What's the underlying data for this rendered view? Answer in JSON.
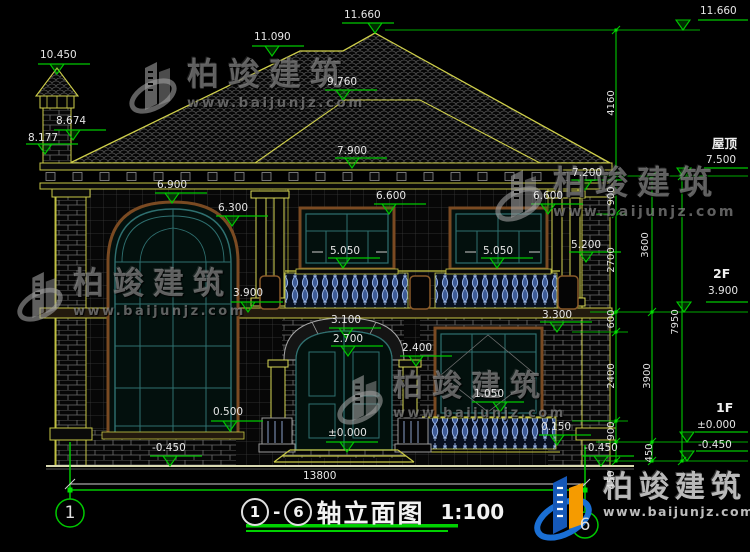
{
  "brand": {
    "name": "柏竣建筑",
    "url": "www.baijunjz.com"
  },
  "title_block": {
    "axis_start": "1",
    "separator": "-",
    "axis_end": "6",
    "name": "轴立面图",
    "scale": "1:100"
  },
  "axis_bubbles": {
    "left": "1",
    "right": "6"
  },
  "floor_labels": {
    "roof": "屋顶",
    "f2": "2F",
    "f1": "1F"
  },
  "overall_dim": {
    "v": "13800",
    "x": 303,
    "y": 471
  },
  "colors": {
    "dim_green": "#00c800",
    "line_yellow": "#c8c846",
    "text": "#e6e6e6",
    "logo_blue": "#1a6fd4",
    "logo_orange": "#f59b00"
  },
  "level_markers": [
    {
      "v": "10.450",
      "ax": 57,
      "ay": 74,
      "tx": 40,
      "ty": 50
    },
    {
      "v": "8.674",
      "ax": 73,
      "ay": 140,
      "tx": 56,
      "ty": 116
    },
    {
      "v": "8.177",
      "ax": 45,
      "ay": 154,
      "tx": 28,
      "ty": 133
    },
    {
      "v": "11.090",
      "ax": 272,
      "ay": 56,
      "tx": 254,
      "ty": 32
    },
    {
      "v": "11.660",
      "ax": 375,
      "ay": 33,
      "tx": 344,
      "ty": 10
    },
    {
      "v": "9.760",
      "ax": 343,
      "ay": 100,
      "tx": 327,
      "ty": 77
    },
    {
      "v": "7.900",
      "ax": 352,
      "ay": 168,
      "tx": 337,
      "ty": 146
    },
    {
      "v": "6.900",
      "ax": 172,
      "ay": 203,
      "tx": 157,
      "ty": 180
    },
    {
      "v": "6.300",
      "ax": 232,
      "ay": 226,
      "tx": 218,
      "ty": 203
    },
    {
      "v": "7.200",
      "ax": 585,
      "ay": 190,
      "tx": 572,
      "ty": 168
    },
    {
      "v": "6.600",
      "ax": 389,
      "ay": 214,
      "tx": 376,
      "ty": 191
    },
    {
      "v": "6.600",
      "ax": 548,
      "ay": 214,
      "tx": 533,
      "ty": 191
    },
    {
      "v": "5.050",
      "ax": 343,
      "ay": 268,
      "tx": 330,
      "ty": 246,
      "arrows": true
    },
    {
      "v": "5.050",
      "ax": 497,
      "ay": 268,
      "tx": 483,
      "ty": 246,
      "arrows": true
    },
    {
      "v": "5.200",
      "ax": 586,
      "ay": 262,
      "tx": 571,
      "ty": 240
    },
    {
      "v": "3.900",
      "ax": 248,
      "ay": 312,
      "tx": 233,
      "ty": 288
    },
    {
      "v": "3.300",
      "ax": 557,
      "ay": 332,
      "tx": 542,
      "ty": 310
    },
    {
      "v": "3.100",
      "ax": 346,
      "ay": 338,
      "tx": 331,
      "ty": 315
    },
    {
      "v": "2.700",
      "ax": 348,
      "ay": 356,
      "tx": 333,
      "ty": 334
    },
    {
      "v": "2.400",
      "ax": 416,
      "ay": 366,
      "tx": 402,
      "ty": 343
    },
    {
      "v": "1.050",
      "ax": 500,
      "ay": 412,
      "tx": 474,
      "ty": 389
    },
    {
      "v": "0.500",
      "ax": 230,
      "ay": 431,
      "tx": 213,
      "ty": 407
    },
    {
      "v": "±0.000",
      "ax": 347,
      "ay": 452,
      "tx": 328,
      "ty": 428
    },
    {
      "v": "0.150",
      "ax": 557,
      "ay": 445,
      "tx": 541,
      "ty": 422
    },
    {
      "v": "-0.450",
      "ax": 170,
      "ay": 466,
      "tx": 152,
      "ty": 443
    },
    {
      "v": "-0.450",
      "ax": 601,
      "ay": 466,
      "tx": 584,
      "ty": 443
    },
    {
      "v": "11.660",
      "ax": 683,
      "ay": 30,
      "tx": 700,
      "ty": 6,
      "long": true
    },
    {
      "v": "7.500",
      "ax": 684,
      "ay": 178,
      "tx": 706,
      "ty": 155,
      "long": true
    },
    {
      "v": "3.900",
      "ax": 684,
      "ay": 312,
      "tx": 708,
      "ty": 286,
      "long": true
    },
    {
      "v": "±0.000",
      "ax": 687,
      "ay": 442,
      "tx": 697,
      "ty": 420,
      "long": true
    },
    {
      "v": "-0.450",
      "ax": 687,
      "ay": 461,
      "tx": 698,
      "ty": 440,
      "long": true
    }
  ],
  "v_dims": [
    {
      "v": "4160",
      "x": 612,
      "y": 103
    },
    {
      "v": "900",
      "x": 612,
      "y": 196
    },
    {
      "v": "2700",
      "x": 612,
      "y": 260
    },
    {
      "v": "600",
      "x": 612,
      "y": 319
    },
    {
      "v": "2400",
      "x": 612,
      "y": 376
    },
    {
      "v": "900",
      "x": 612,
      "y": 431
    },
    {
      "v": "450",
      "x": 612,
      "y": 480
    },
    {
      "v": "3600",
      "x": 646,
      "y": 245
    },
    {
      "v": "3900",
      "x": 648,
      "y": 376
    },
    {
      "v": "450",
      "x": 650,
      "y": 453
    },
    {
      "v": "7950",
      "x": 676,
      "y": 322
    }
  ]
}
